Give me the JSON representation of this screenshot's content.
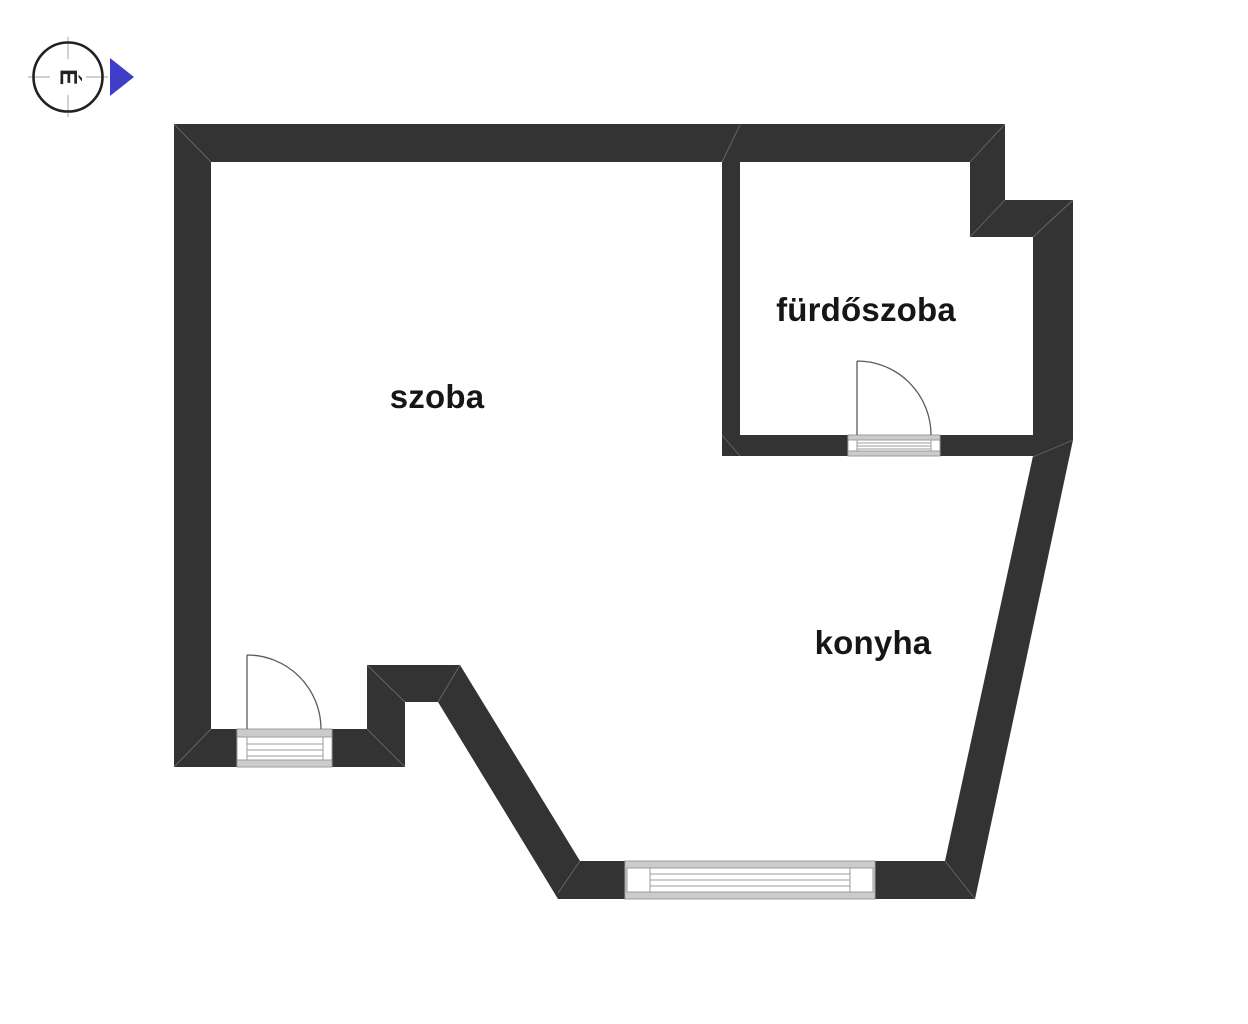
{
  "compass": {
    "letter": "É",
    "arrow_color": "#3e3ec8"
  },
  "rooms": [
    {
      "name": "szoba"
    },
    {
      "name": "fürdőszoba"
    },
    {
      "name": "konyha"
    }
  ],
  "icons": {
    "compass": "compass-rose-icon",
    "north_arrow": "north-arrow-icon"
  },
  "colors": {
    "wall": "#333333",
    "background": "#ffffff",
    "seam": "#7a7a7a",
    "door_stroke": "#5a5a5a",
    "fixture_gray": "#cbcbcb",
    "fixture_outline": "#9c9c9c",
    "text": "#161616",
    "compass_ring": "#222222",
    "crosshair": "#b3b3b3"
  }
}
